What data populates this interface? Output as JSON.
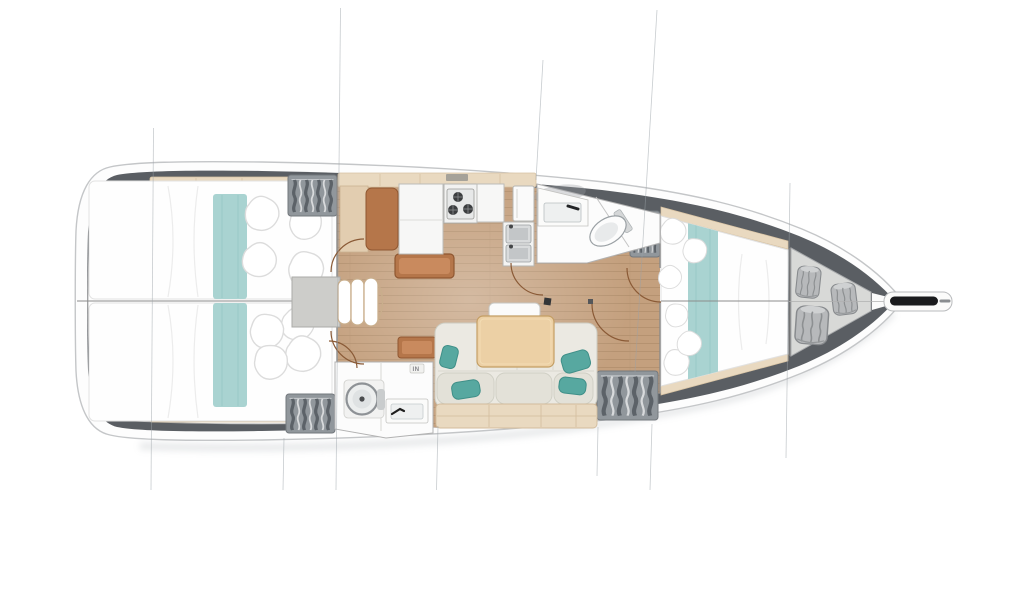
{
  "document": {
    "kind": "sailing-yacht-interior-floor-plan",
    "view": "top-down deck plan drawing",
    "orientation": {
      "bow": "right",
      "stern": "left"
    },
    "background": "#ffffff"
  },
  "labels": {
    "aft_head_chip": "IN"
  },
  "colors": {
    "hull_fill": "#fdfdfd",
    "hull_stroke": "#c4c6c8",
    "deck_band": "#5a5e63",
    "interior_fill": "#fdfdfd",
    "wood_floor": "#c4a07e",
    "beige_trim": "#e9d9c0",
    "brown_furniture": "#b5764a",
    "table_oak": "#ecd0a5",
    "sofa_fill": "#ebe9e2",
    "teal_pillow": "#57a8a0",
    "teal_runner": "#a9d3d1",
    "wardrobe_grey": "#91979c",
    "locker_grey": "#d8d9d7",
    "fender_grey": "#b7b9bb",
    "section_line": "#9aa2a8",
    "door_arc": "#8a5a36"
  },
  "compartments": [
    {
      "id": "aft-cabin-port",
      "berth": "double",
      "features": [
        "mattress",
        "teal-runner",
        "pillows",
        "wardrobe",
        "door-arc"
      ]
    },
    {
      "id": "aft-cabin-starboard",
      "berth": "double",
      "features": [
        "mattress",
        "teal-runner",
        "pillows",
        "wardrobe",
        "door-arc"
      ]
    },
    {
      "id": "companionway",
      "features": [
        "steps-x3",
        "engine-box"
      ]
    },
    {
      "id": "galley",
      "features": [
        "l-counter",
        "stove-3-burner",
        "double-sink",
        "fridge",
        "nav-seat",
        "coffee-table"
      ]
    },
    {
      "id": "forward-head",
      "features": [
        "washbasin",
        "toilet",
        "shower-partition",
        "door-arc",
        "wardrobe"
      ]
    },
    {
      "id": "aft-head",
      "features": [
        "washbasin",
        "toilet",
        "door-arc",
        "in-chip"
      ]
    },
    {
      "id": "salon",
      "features": [
        "u-sofa",
        "teal-cushions-x4",
        "dining-table",
        "bench",
        "mast-post"
      ]
    },
    {
      "id": "forward-cabin",
      "berth": "v-double",
      "features": [
        "mattress",
        "teal-runner",
        "pillows",
        "wardrobe"
      ]
    },
    {
      "id": "sail-locker",
      "features": [
        "fender-bags-x3"
      ]
    },
    {
      "id": "bow",
      "features": [
        "anchor-sprit"
      ]
    }
  ],
  "section_lines_x": [
    152,
    284,
    338,
    437,
    540,
    652,
    788
  ]
}
